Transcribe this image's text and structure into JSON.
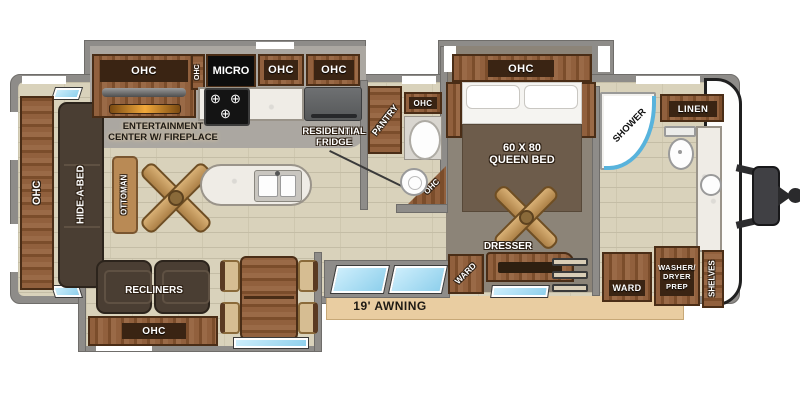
{
  "title": "Travel trailer floor plan",
  "colors": {
    "wall": "#8e8c89",
    "floor_tile": "#d9d2bb",
    "carpet": "#8c8478",
    "wood": "#8a5a36",
    "label_band": "#3a2413",
    "awning": "#e9cda1",
    "window_blue": "#aadcf0",
    "marble": "#efece6",
    "fireplace_glow": "#f2a93b",
    "hitch": "#2c2c2e"
  },
  "labels": {
    "rear_ohc": "OHC",
    "hide_a_bed": "HIDE-A-BED",
    "ottoman": "OTTOMAN",
    "ent_line1": "ENTERTAINMENT",
    "ent_line2": "CENTER W/ FIREPLACE",
    "ent_ohc": "OHC",
    "kitchen_ohc_side": "OHC",
    "micro": "MICRO",
    "kitchen_ohc1": "OHC",
    "kitchen_ohc2": "OHC",
    "fridge_line1": "RESIDENTIAL",
    "fridge_line2": "FRIDGE",
    "pantry": "PANTRY",
    "midbath_ohc": "OHC",
    "midbath_corner_ohc": "OHC",
    "bedroom_ohc": "OHC",
    "bed_line1": "60 X 80",
    "bed_line2": "QUEEN BED",
    "dresser": "DRESSER",
    "bedroom_ward": "WARD",
    "shower": "SHOWER",
    "linen": "LINEN",
    "bath_ward": "WARD",
    "washer_line1": "WASHER/",
    "washer_line2": "DRYER",
    "washer_line3": "PREP",
    "shelves": "SHELVES",
    "recliners": "RECLINERS",
    "recliners_ohc": "OHC",
    "awning": "19' AWNING"
  }
}
